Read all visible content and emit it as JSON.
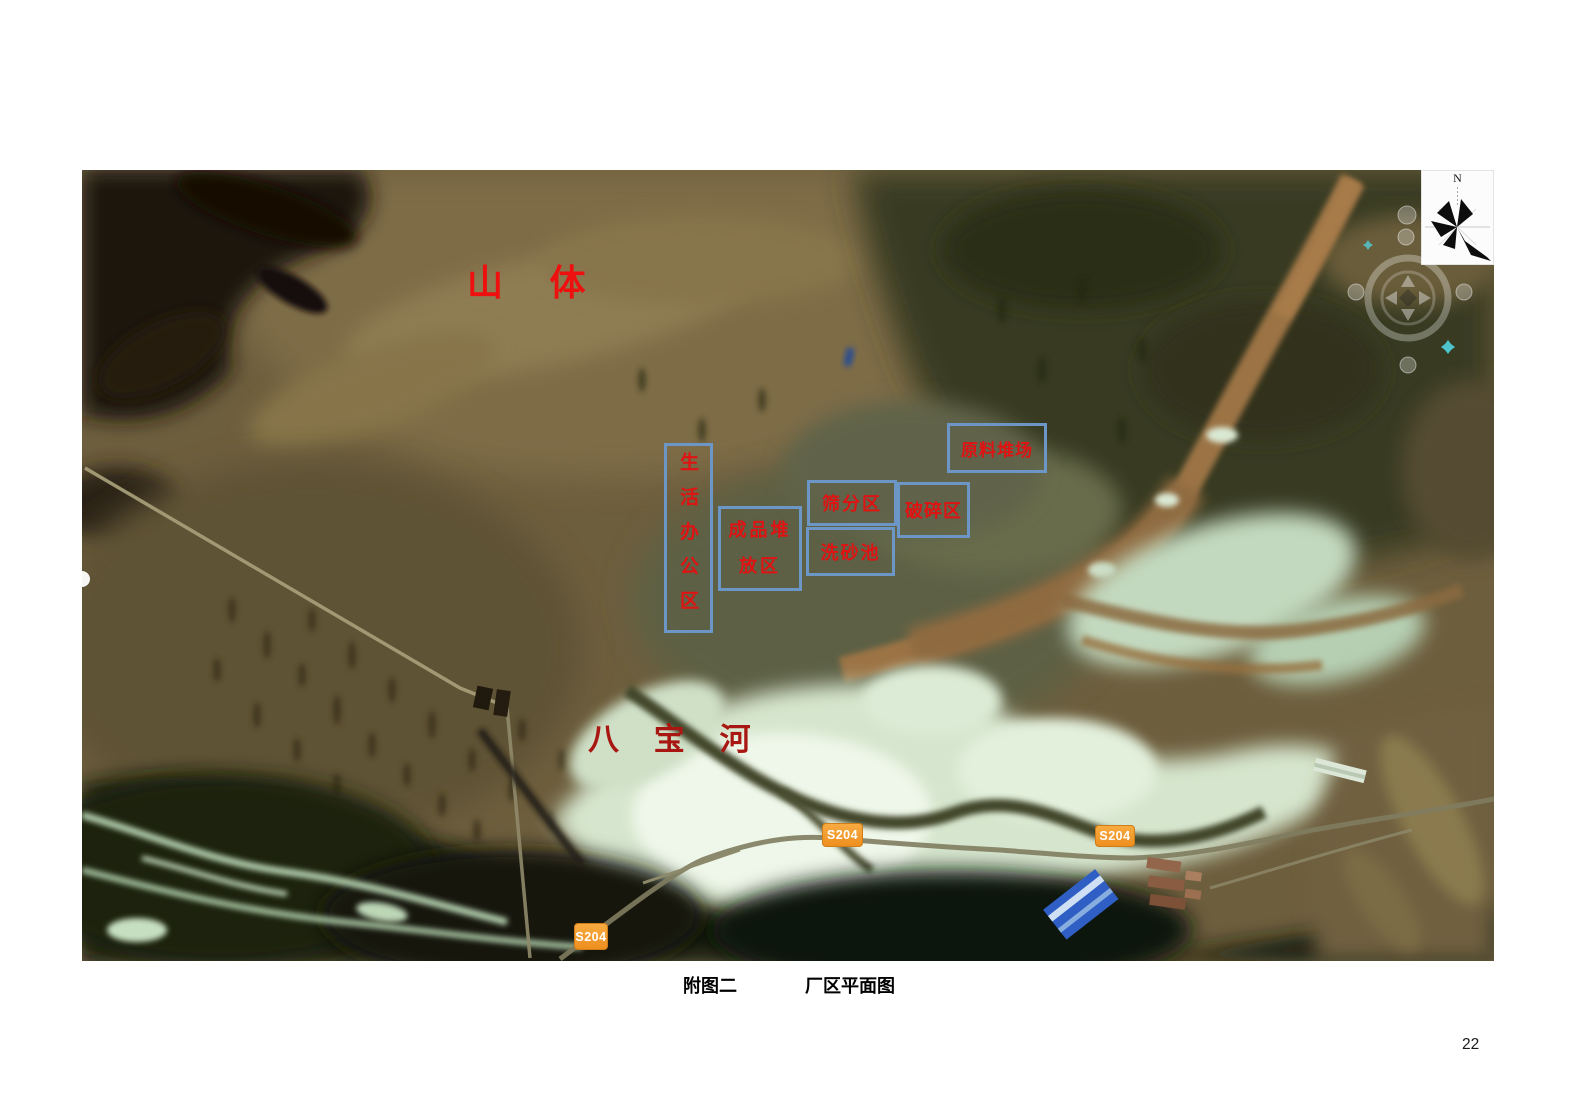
{
  "page": {
    "number": "22"
  },
  "caption": {
    "figure_label": "附图二",
    "figure_title": "厂区平面图"
  },
  "map": {
    "terrain_labels": [
      {
        "id": "mountain",
        "text": "山 体"
      },
      {
        "id": "babao-river",
        "text": "八 宝 河"
      }
    ],
    "zones": [
      {
        "id": "living-office",
        "label": "生活办公区"
      },
      {
        "id": "finished-product-stacking",
        "label": "成品堆放区"
      },
      {
        "id": "screening",
        "label": "筛分区"
      },
      {
        "id": "sand-washing-pool",
        "label": "洗砂池"
      },
      {
        "id": "crushing",
        "label": "破碎区"
      },
      {
        "id": "raw-material-yard",
        "label": "原料堆场"
      }
    ],
    "road_badges": [
      {
        "id": "s204-center",
        "text": "S204"
      },
      {
        "id": "s204-right",
        "text": "S204"
      },
      {
        "id": "s204-bottom",
        "text": "S204"
      }
    ],
    "compass": {
      "north": "N"
    },
    "colors": {
      "zone_border": "#6c96c6",
      "zone_text": "#e01212",
      "mountain_text": "#ee0f0f",
      "river_text": "#a81712",
      "badge_bg": "#f0962b",
      "badge_text": "#ffffff"
    }
  }
}
